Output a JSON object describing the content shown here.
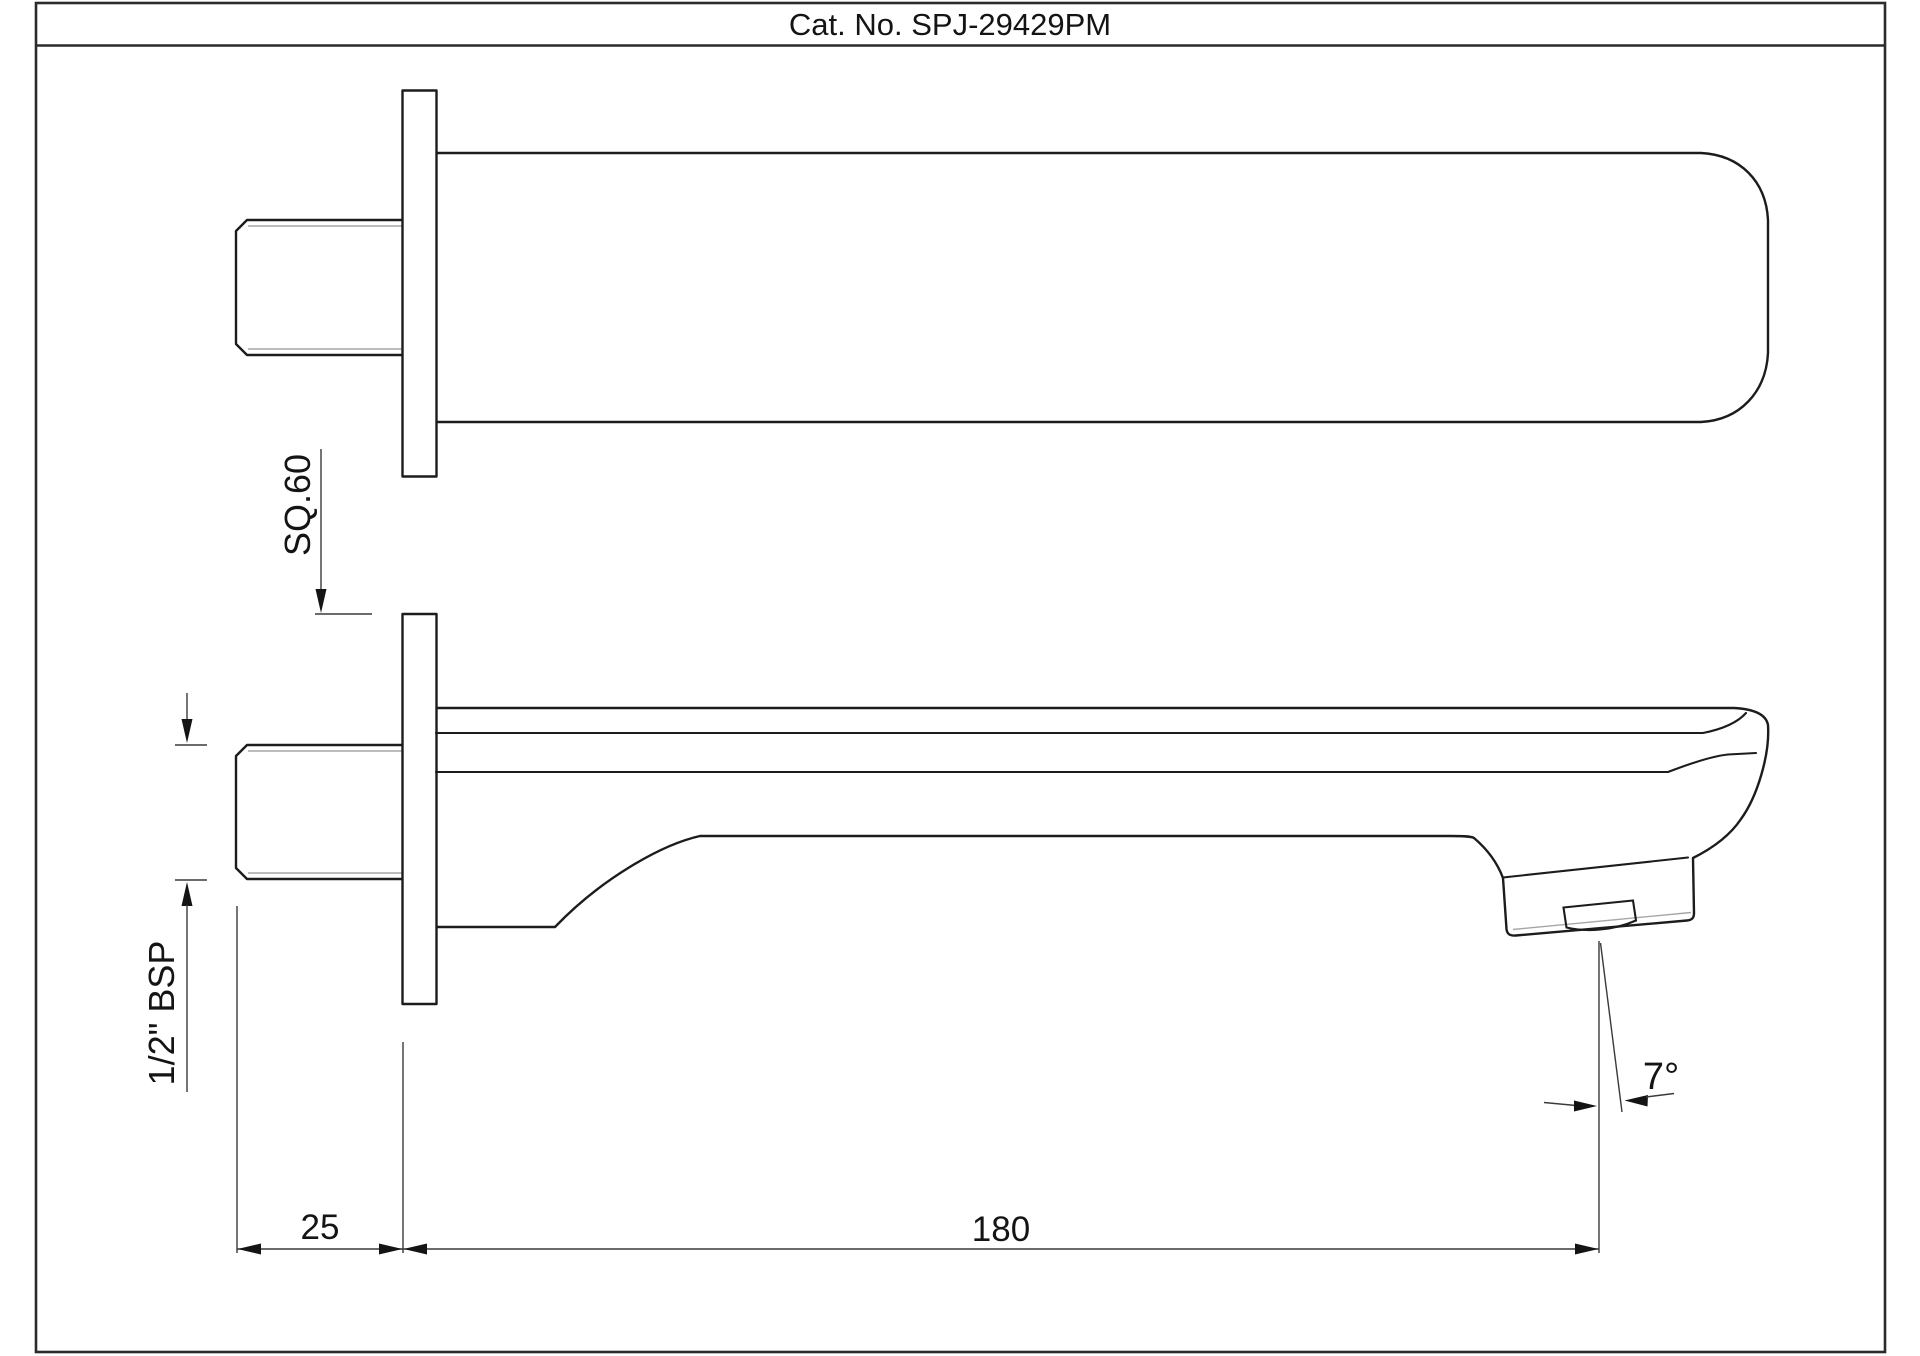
{
  "title": {
    "label": "Cat. No. SPJ-29429PM"
  },
  "drawing": {
    "type": "technical-spec-drawing",
    "product": "wall-mounted bath spout",
    "views": {
      "top_view": "plan view of spout with wall flange and threaded inlet",
      "side_view": "elevation of spout with aerator nozzle and spray angle"
    }
  },
  "dimensions": {
    "flange_square": "SQ.60",
    "thread_size": "1/2\" BSP",
    "wall_offset": "25",
    "spout_length": "180",
    "spray_angle": "7°"
  },
  "colors": {
    "background": "#ffffff",
    "main_outline": "#1c1c1c",
    "thin_detail": "#a6a6a6",
    "dimension_lines": "#3a3a3a",
    "text": "#141414"
  }
}
